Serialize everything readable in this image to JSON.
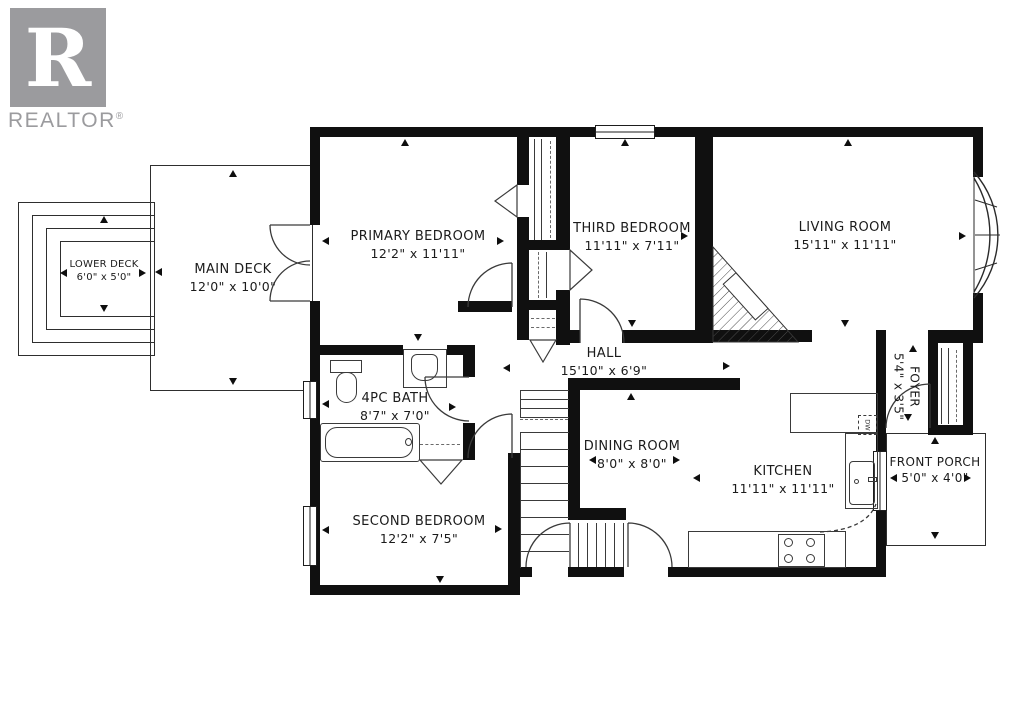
{
  "logo": {
    "letter": "R",
    "brand": "REALTOR",
    "registered": "®"
  },
  "rooms": {
    "lower_deck": {
      "name": "LOWER DECK",
      "dims": "6'0\" x 5'0\""
    },
    "main_deck": {
      "name": "MAIN DECK",
      "dims": "12'0\" x 10'0\""
    },
    "primary_bedroom": {
      "name": "PRIMARY BEDROOM",
      "dims": "12'2\" x 11'11\""
    },
    "third_bedroom": {
      "name": "THIRD BEDROOM",
      "dims": "11'11\" x 7'11\""
    },
    "living_room": {
      "name": "LIVING ROOM",
      "dims": "15'11\" x 11'11\""
    },
    "hall": {
      "name": "HALL",
      "dims": "15'10\" x 6'9\""
    },
    "bath": {
      "name": "4PC BATH",
      "dims": "8'7\" x 7'0\""
    },
    "dining_room": {
      "name": "DINING ROOM",
      "dims": "8'0\" x 8'0\""
    },
    "kitchen": {
      "name": "KITCHEN",
      "dims": "11'11\" x 11'11\""
    },
    "foyer": {
      "name": "FOYER",
      "dims": "5'4\" x 3'5\""
    },
    "front_porch": {
      "name": "FRONT PORCH",
      "dims": "5'0\" x 4'0\""
    },
    "second_bedroom": {
      "name": "SECOND BEDROOM",
      "dims": "12'2\" x 7'5\""
    }
  },
  "labels": {
    "dishwasher": "DW"
  },
  "colors": {
    "wall": "#101010",
    "line": "#3a3a3a",
    "logo_gray": "#9b9b9e",
    "background": "#ffffff"
  }
}
